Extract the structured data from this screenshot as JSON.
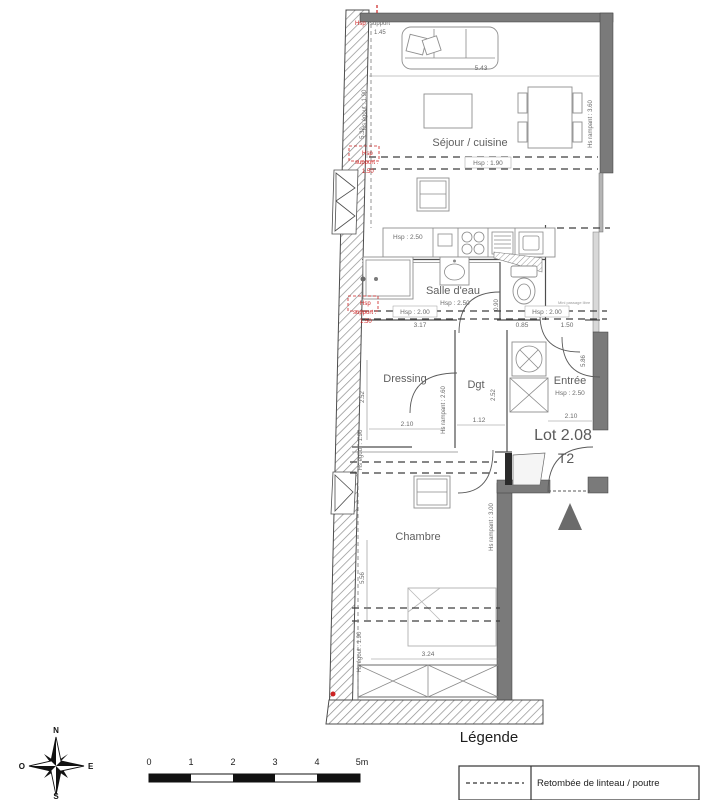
{
  "plan": {
    "rooms": {
      "sejour": {
        "label": "Séjour / cuisine"
      },
      "salle_eau": {
        "label": "Salle d'eau",
        "height": "Hsp : 2.50"
      },
      "dressing": {
        "label": "Dressing"
      },
      "dgt": {
        "label": "Dgt"
      },
      "entree": {
        "label": "Entrée",
        "height": "Hsp : 2.50"
      },
      "chambre": {
        "label": "Chambre"
      }
    },
    "kitchen_height": "Hsp : 2.50",
    "beams": {
      "sejour": "Hsp : 1.90",
      "bath_left": "Hsp : 2.00",
      "bath_right": "Hsp : 2.00"
    },
    "dims": {
      "sejour_w": "5.43",
      "sejour_h": "5.32",
      "bath_w": "3.17",
      "wc_a": "0.85",
      "wc_b": "1.50",
      "wc_w": "0.90",
      "dressing_h": "2.52",
      "dressing_w": "2.10",
      "dgt_h": "2.52",
      "dgt_w": "1.12",
      "entree_w": "2.10",
      "entree_h": "5.86",
      "chambre_h": "5.56",
      "chambre_w": "3.24"
    },
    "heights": {
      "egout_top": "Hs égout : 1.90",
      "rampant_right": "Hs rampant : 3.60",
      "rampant_mid": "Hs rampant : 2.60",
      "rampant_chambre": "Hs rampant : 3.00",
      "egout_mid": "Hs égout : 1.90",
      "egout_bottom": "Hs égout : 1.90"
    },
    "supports": {
      "top": {
        "a": "Hsp",
        "b": "support",
        "c": "1.45"
      },
      "mid": {
        "a": "Hsp",
        "b": "support :",
        "c": "1.50"
      },
      "low": {
        "a": "Hsp",
        "b": "support :",
        "c": "1.50"
      }
    },
    "notes": {
      "passage": "Mini passage libre"
    },
    "lot": {
      "number": "Lot 2.08",
      "type": "T2"
    }
  },
  "legend": {
    "title": "Légende",
    "items": [
      {
        "symbol": "dashed-line",
        "label": "Retombée de linteau / poutre"
      }
    ]
  },
  "scalebar": {
    "labels": [
      "0",
      "1",
      "2",
      "3",
      "4",
      "5m"
    ]
  },
  "compass": {
    "n": "N",
    "e": "E",
    "s": "S",
    "o": "O"
  },
  "colors": {
    "wall": "#7a7a7a",
    "beam_line": "#3f3f3f",
    "annotation_red": "#cc2222",
    "text": "#666666"
  }
}
